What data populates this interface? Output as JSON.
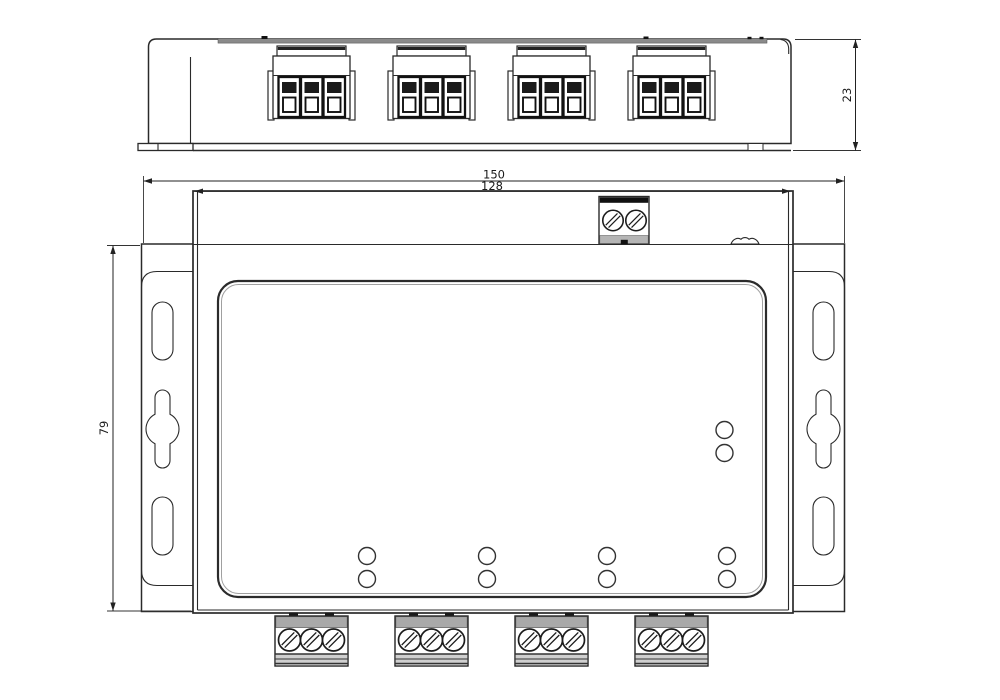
{
  "colors": {
    "line": "#2a2a2a",
    "background": "#ffffff"
  },
  "dimensions": {
    "overall_width_mm": "150",
    "body_width_mm": "128",
    "plate_height_mm": "79",
    "device_depth_mm": "23"
  }
}
